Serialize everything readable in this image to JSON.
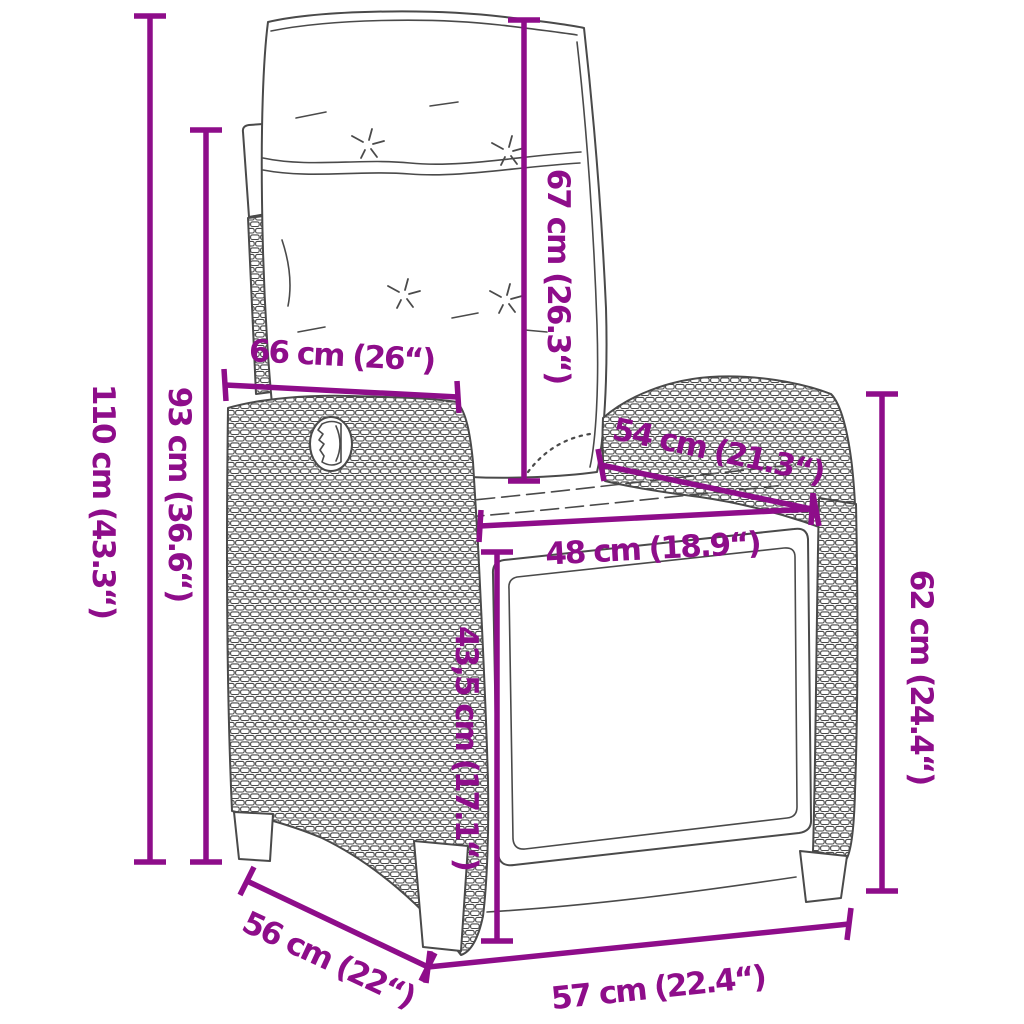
{
  "page": {
    "background": "#ffffff"
  },
  "diagram": {
    "type": "product-dimensions",
    "subject": "reclining garden chair with cushions, rattan line drawing",
    "accent_color": "#8E0D8A",
    "outline_color": "#4a4a4a",
    "dimensions": [
      {
        "id": "overall-height",
        "label": "110 cm (43.3“)"
      },
      {
        "id": "backrest-height",
        "label": "93 cm (36.6“)"
      },
      {
        "id": "backrest-width",
        "label": "66 cm (26“)"
      },
      {
        "id": "back-cushion-height",
        "label": "67 cm (26.3“)"
      },
      {
        "id": "armrest-depth",
        "label": "54 cm (21.3“)"
      },
      {
        "id": "seat-width",
        "label": "48 cm (18.9“)"
      },
      {
        "id": "seat-front-height",
        "label": "43,5 cm (17.1“)"
      },
      {
        "id": "armrest-height",
        "label": "62 cm (24.4“)"
      },
      {
        "id": "seat-depth",
        "label": "56 cm (22“)"
      },
      {
        "id": "overall-width",
        "label": "57 cm (22.4“)"
      }
    ]
  }
}
